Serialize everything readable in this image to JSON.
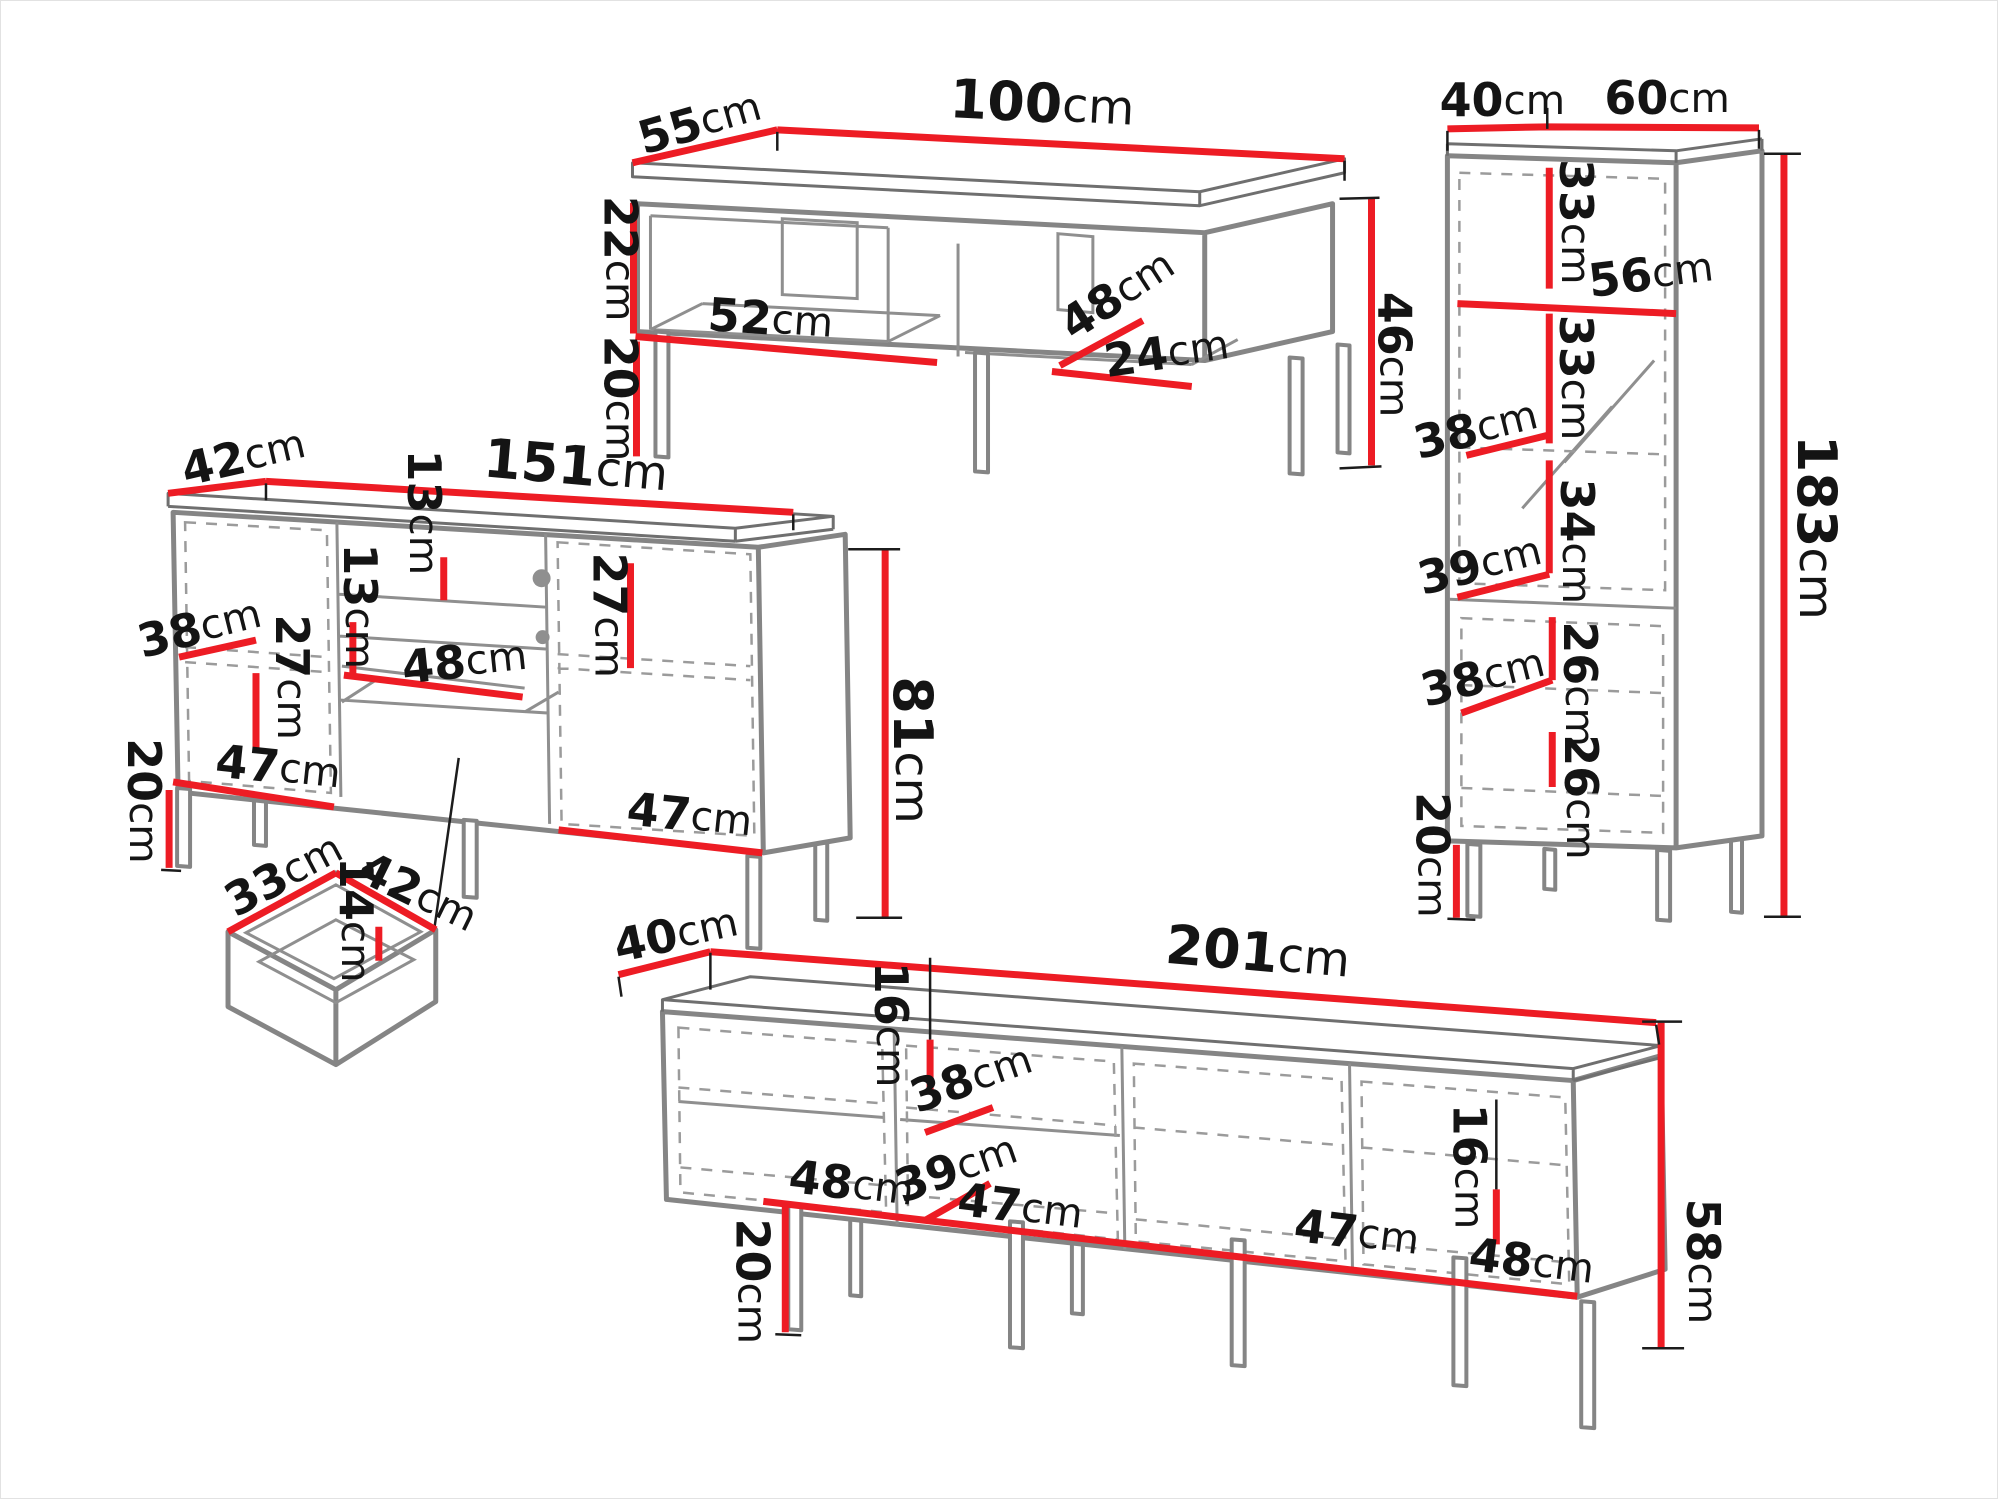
{
  "meta": {
    "title": "Furniture set dimensions diagram"
  },
  "unit": "cm",
  "colors": {
    "dim-line": "#ed1c24",
    "outline": "#858585",
    "outline-dark": "#6f6f6f",
    "interior": "#8f8f8f",
    "dash": "#9b9b9b",
    "label": "#141414",
    "tick": "#1c1c1c",
    "bg": "#ffffff",
    "border": "#e2e2e2"
  },
  "pieces": {
    "coffee_table": {
      "label": "coffee-table",
      "dims": {
        "top_width": "100",
        "top_depth": "55",
        "body_height": "22",
        "leg_height": "20",
        "shelf_width": "52",
        "compartment_depth": "48",
        "niche_width": "24",
        "total_height": "46"
      }
    },
    "tall_cabinet": {
      "label": "tall-cabinet",
      "dims": {
        "top_depth": "40",
        "top_width": "60",
        "upper_shelf_height": "33",
        "interior_width": "56",
        "second_shelf_height": "33",
        "upper_shelf_depth": "38",
        "middle_shelf_height": "34",
        "middle_shelf_depth": "39",
        "lower_shelf_height": "26",
        "lower_shelf_depth": "38",
        "bottom_shelf_height": "26",
        "leg_height": "20",
        "total_height": "183"
      }
    },
    "sideboard": {
      "label": "sideboard",
      "dims": {
        "top_depth": "42",
        "top_width": "151",
        "upper_drawer_height": "13",
        "lower_drawer_height": "13",
        "shelf_depth": "38",
        "left_interior_height": "27",
        "niche_width": "48",
        "right_interior_height": "27",
        "left_interior_width": "47",
        "right_interior_width": "47",
        "leg_height": "20",
        "total_height": "81"
      }
    },
    "drawer": {
      "label": "drawer-inset",
      "dims": {
        "width": "33",
        "depth": "42",
        "height": "14"
      }
    },
    "tv_stand": {
      "label": "tv-stand",
      "dims": {
        "top_depth": "40",
        "top_width": "201",
        "left_shelf_height": "16",
        "shelf_depth": "38",
        "section1_width": "48",
        "bottom_depth": "39",
        "section2_width": "47",
        "section3_width": "47",
        "right_shelf_height": "16",
        "section4_width": "48",
        "leg_height": "20",
        "total_height": "58"
      }
    }
  }
}
